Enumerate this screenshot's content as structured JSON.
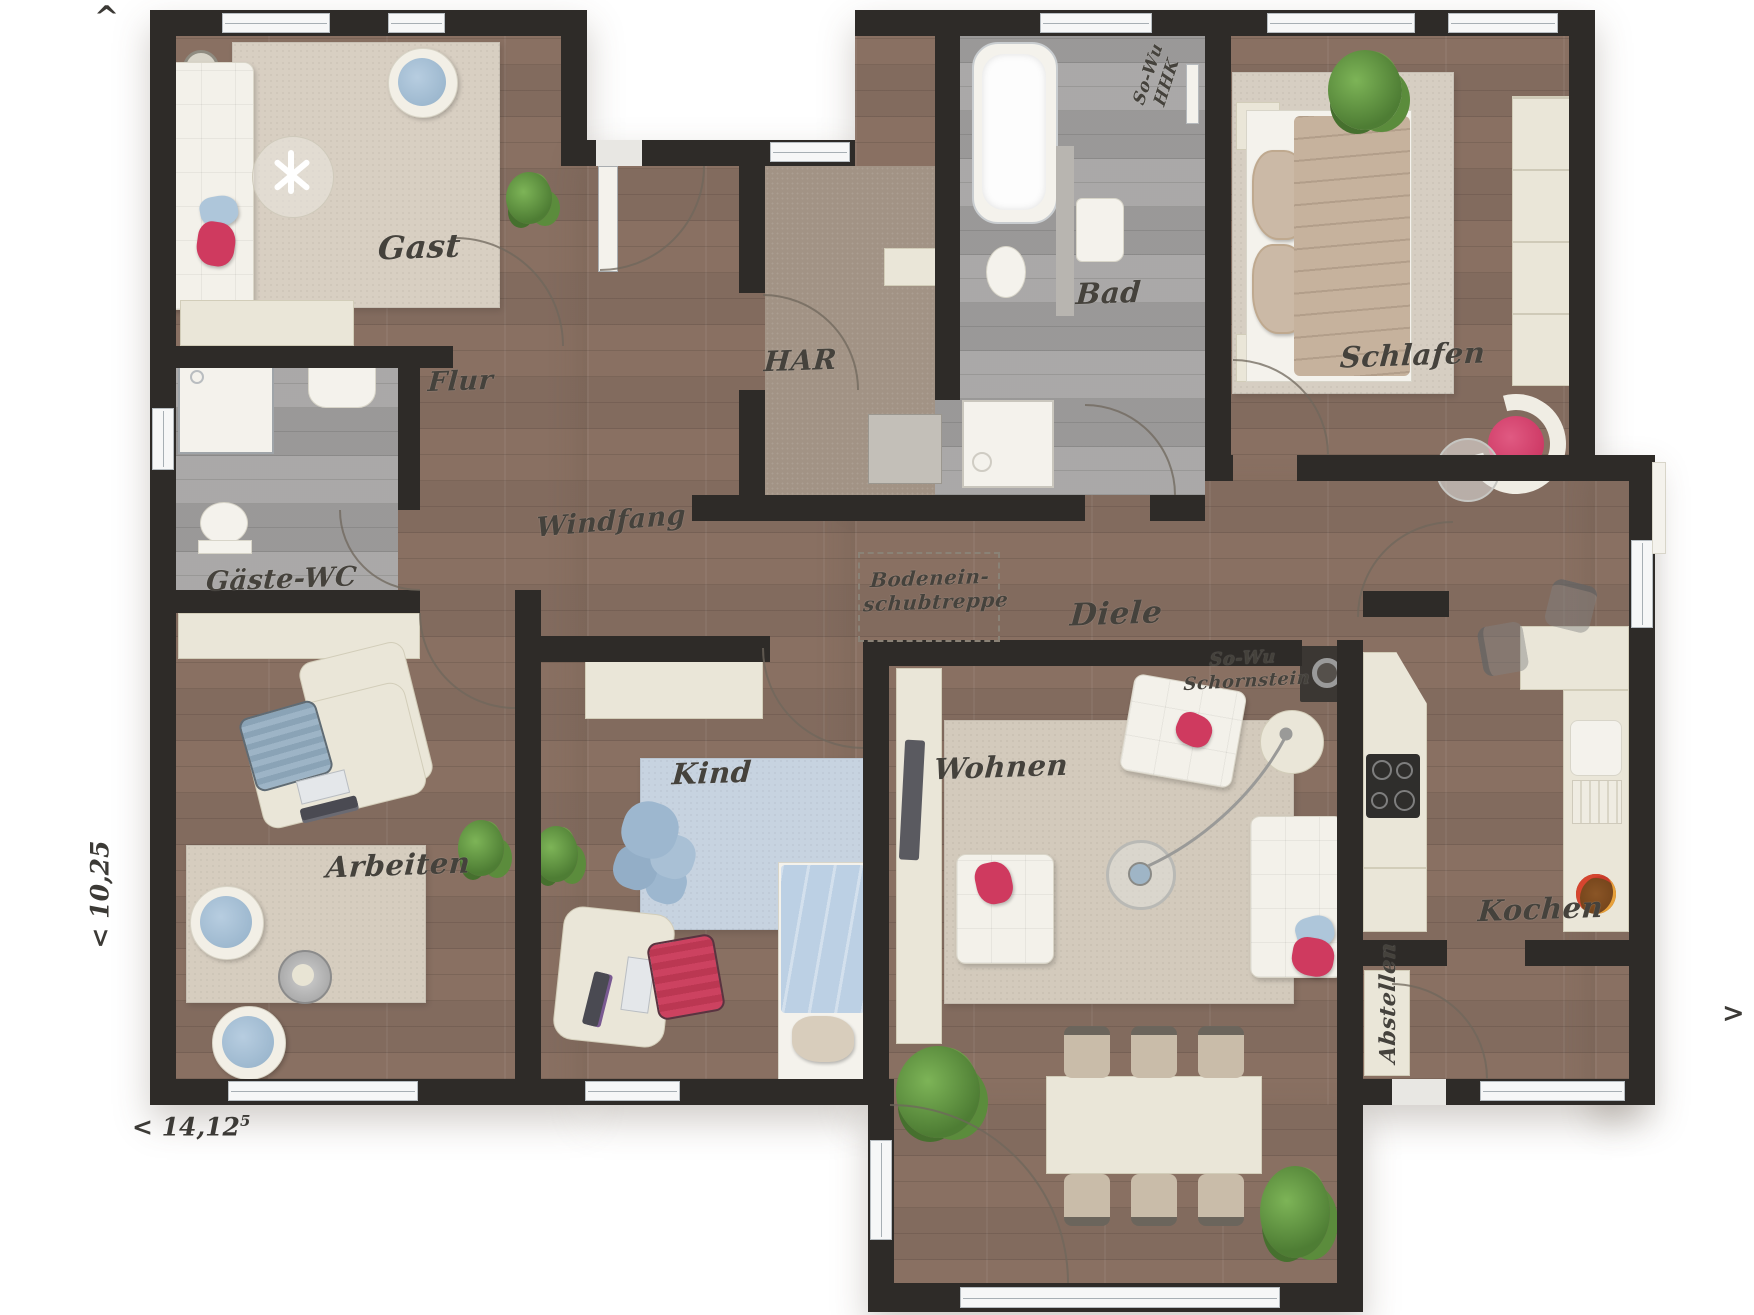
{
  "rooms": {
    "gast": "Gast",
    "flur": "Flur",
    "gaeste_wc": "Gäste-WC",
    "arbeiten": "Arbeiten",
    "windfang": "Windfang",
    "kind": "Kind",
    "har": "HAR",
    "bad": "Bad",
    "schlafen": "Schlafen",
    "diele": "Diele",
    "wohnen": "Wohnen",
    "kochen": "Kochen",
    "abstellen": "Abstellen"
  },
  "annotations": {
    "attic_stairs": {
      "line1": "Bodenein-",
      "line2": "schubtreppe"
    },
    "chimney": {
      "line1": "So-Wu",
      "line2": "Schornstein"
    },
    "heating": {
      "line1": "So-Wu",
      "line2": "HHK"
    }
  },
  "dimensions": {
    "width": "< 14,12",
    "width_sup": "5",
    "depth": "< 10,25",
    "arrow_up": "^",
    "arrow_right": ">"
  },
  "colors": {
    "wall": "#2e2b28",
    "wood_floor": "#8b7366",
    "gray_floor": "#a4a2a1",
    "har_floor": "#a29385",
    "rug_beige": "#d6cdbf",
    "rug_blue": "#c7d3e0",
    "accent_red": "#cf3a5f",
    "accent_blue": "#aec6da",
    "plant_green": "#5b8c3c",
    "furniture_cream": "#eae6d8"
  }
}
